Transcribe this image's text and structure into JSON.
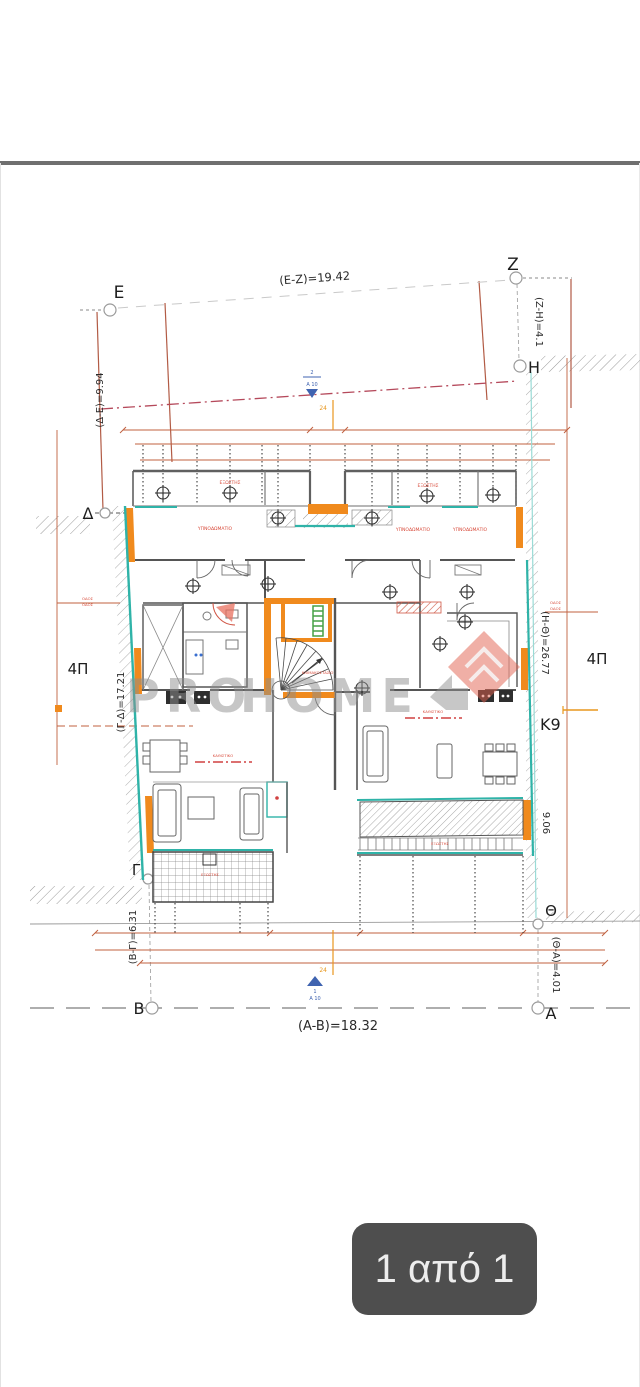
{
  "pager": {
    "label": "1 από 1"
  },
  "watermark": {
    "part1": "PRO",
    "part2": "HOME"
  },
  "plan": {
    "points": {
      "E": "E",
      "Z": "Z",
      "H": "H",
      "D": "Δ",
      "G": "Γ",
      "B": "B",
      "A": "A",
      "TH": "Θ"
    },
    "grid_refs": {
      "k9": "K9",
      "floor_left": "4Π",
      "floor_right": "4Π"
    },
    "dims": {
      "ez": "(E-Z)=19.42",
      "ab": "(A-B)=18.32",
      "zh": "(Z-H)=4.1",
      "de": "(Δ-Ε)=9.94",
      "gd": "(Γ-Δ)=17.21",
      "bg": "(Β-Γ)=6.31",
      "hth": "(H-Θ)=26.77",
      "tha": "(Θ-Α)=4.01",
      "right_height": "9.06",
      "small_orange": "24"
    },
    "section_markers": {
      "top_num": "2",
      "top_ref": "A 10",
      "bottom_num": "1",
      "bottom_ref": "A 10"
    },
    "room_labels": {
      "bedroom": "ΥΠΝΟΔΩΜΑΤΙΟ",
      "balcony": "ΕΞΩΣΤΗΣ",
      "living": "ΚΑΘΙΣΤΙΚΟ",
      "street": "ΟΔΟΣ",
      "stair": "ΚΛΙΜΑΚΟΣΤΑΣΙΟ"
    }
  },
  "colors": {
    "wall_orange": "#f08a1d",
    "wall_teal": "#2fb3a8",
    "dim_red": "#c0603f",
    "boundary_red": "#b5495b",
    "marker_blue": "#3f63b0",
    "badge_bg": "#4e4e4e",
    "watermark_gray": "#8e8e8e",
    "logo_salmon": "#e2604d",
    "accent_green": "#46a046"
  }
}
